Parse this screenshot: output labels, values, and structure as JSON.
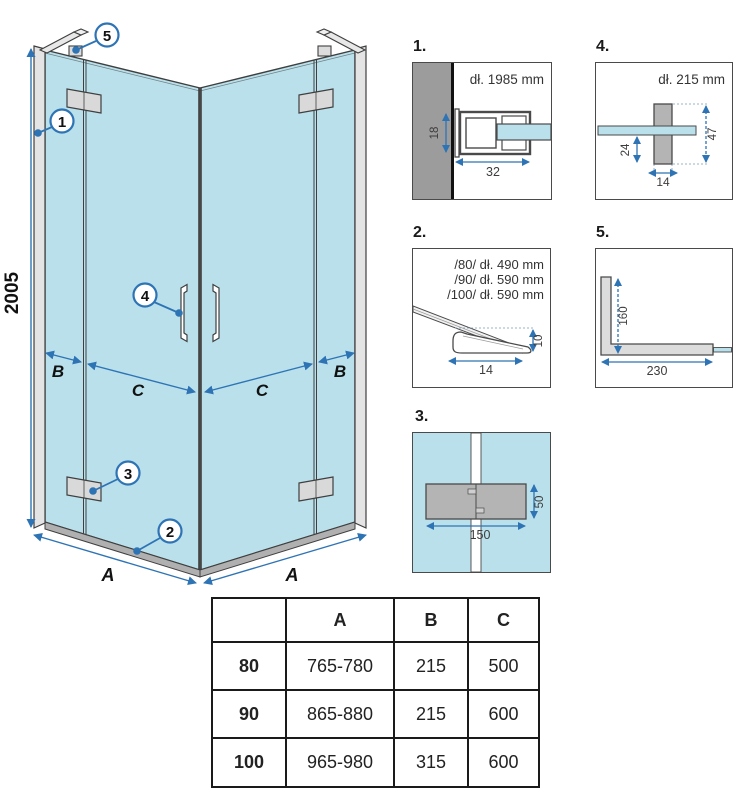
{
  "colors": {
    "glass_blue": "#b9e0eb",
    "dimension_blue": "#2e74b5",
    "outline_dark": "#3f3f3f",
    "wall_gray": "#9c9c9c",
    "profile_gray": "#e4e4e4",
    "hinge_gray": "#d9d9d9",
    "part_gray": "#b4b4b4"
  },
  "main": {
    "height_dim": "2005",
    "label_b": "B",
    "label_c": "C",
    "label_a": "A",
    "callout_1": "1",
    "callout_2": "2",
    "callout_3": "3",
    "callout_4": "4",
    "callout_5": "5"
  },
  "detail1": {
    "label": "1.",
    "title": "dł. 1985 mm",
    "dim_height": "18",
    "dim_width": "32"
  },
  "detail2": {
    "label": "2.",
    "line_80": "/80/ dł. 490 mm",
    "line_90": "/90/ dł. 590 mm",
    "line_100": "/100/ dł. 590 mm",
    "dim_height": "10",
    "dim_width": "14"
  },
  "detail3": {
    "label": "3.",
    "dim_width": "150",
    "dim_height": "50"
  },
  "detail4": {
    "label": "4.",
    "title": "dł. 215 mm",
    "dim_left": "24",
    "dim_right": "47",
    "dim_width": "14"
  },
  "detail5": {
    "label": "5.",
    "dim_vertical": "160",
    "dim_horizontal": "230"
  },
  "table": {
    "headers": [
      "",
      "A",
      "B",
      "C"
    ],
    "rows": [
      [
        "80",
        "765-780",
        "215",
        "500"
      ],
      [
        "90",
        "865-880",
        "215",
        "600"
      ],
      [
        "100",
        "965-980",
        "315",
        "600"
      ]
    ]
  }
}
